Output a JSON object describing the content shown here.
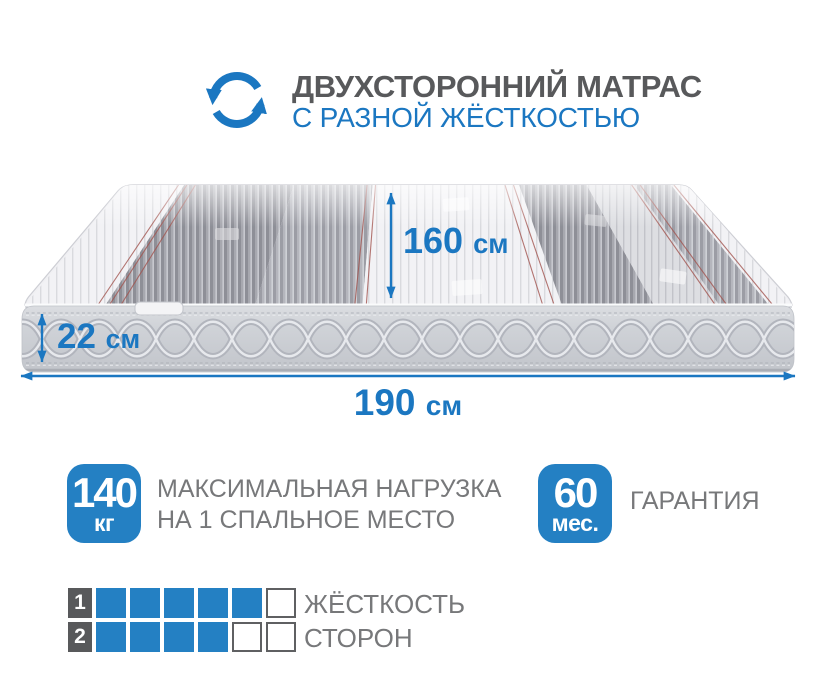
{
  "colors": {
    "accent_blue": "#1b77c1",
    "badge_blue": "#2480c3",
    "title_gray": "#58595b",
    "text_gray": "#77787a",
    "red_pinstripe": "#a2544f"
  },
  "header": {
    "icon": "rotate-arrows-icon",
    "title": "ДВУХСТОРОННИЙ МАТРАС",
    "subtitle": "С РАЗНОЙ ЖЁСТКОСТЬЮ"
  },
  "mattress": {
    "depth": {
      "value": "160",
      "unit": "см"
    },
    "height": {
      "value": "22",
      "unit": "см"
    },
    "length": {
      "value": "190",
      "unit": "см"
    }
  },
  "features": {
    "max_load": {
      "value": "140",
      "unit": "кг",
      "line1": "МАКСИМАЛЬНАЯ НАГРУЗКА",
      "line2": "НА 1 СПАЛЬНОЕ МЕСТО"
    },
    "warranty": {
      "value": "60",
      "unit": "мес.",
      "label": "ГАРАНТИЯ"
    }
  },
  "hardness_scale": {
    "label_line1": "ЖЁСТКОСТЬ",
    "label_line2": "СТОРОН",
    "rows": [
      {
        "side": "1",
        "filled": 5,
        "total": 6
      },
      {
        "side": "2",
        "filled": 4,
        "total": 6
      }
    ]
  }
}
